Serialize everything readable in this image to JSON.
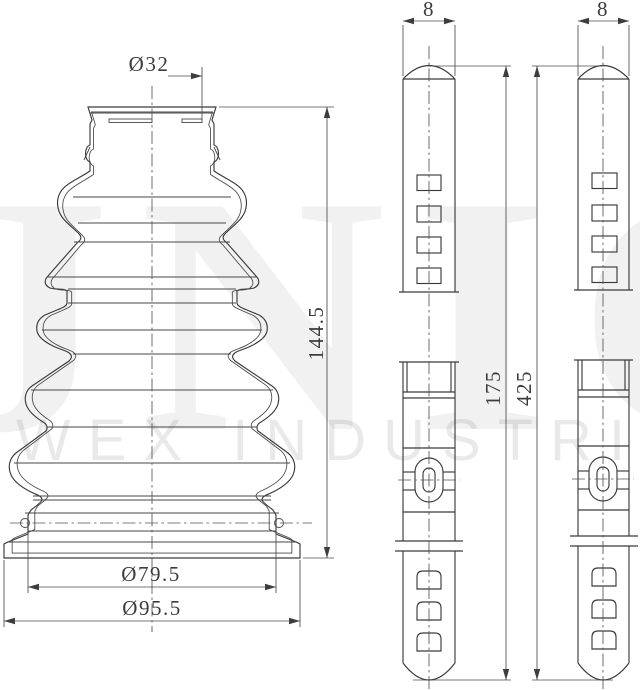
{
  "watermark": {
    "brand": "JNIC",
    "company": "WEX INDUSTRIES"
  },
  "boot": {
    "dim_top_diameter": "Ø32",
    "dim_height": "144.5",
    "dim_groove_diameter": "Ø79.5",
    "dim_base_diameter": "Ø95.5"
  },
  "clamp_small": {
    "dim_width": "8",
    "dim_length": "175"
  },
  "clamp_large": {
    "dim_width": "8",
    "dim_length": "425"
  },
  "colors": {
    "line": "#3a3a3a",
    "dimension": "#4c4c4c",
    "background": "#ffffff",
    "watermark": "rgba(0,0,0,0.06)"
  }
}
